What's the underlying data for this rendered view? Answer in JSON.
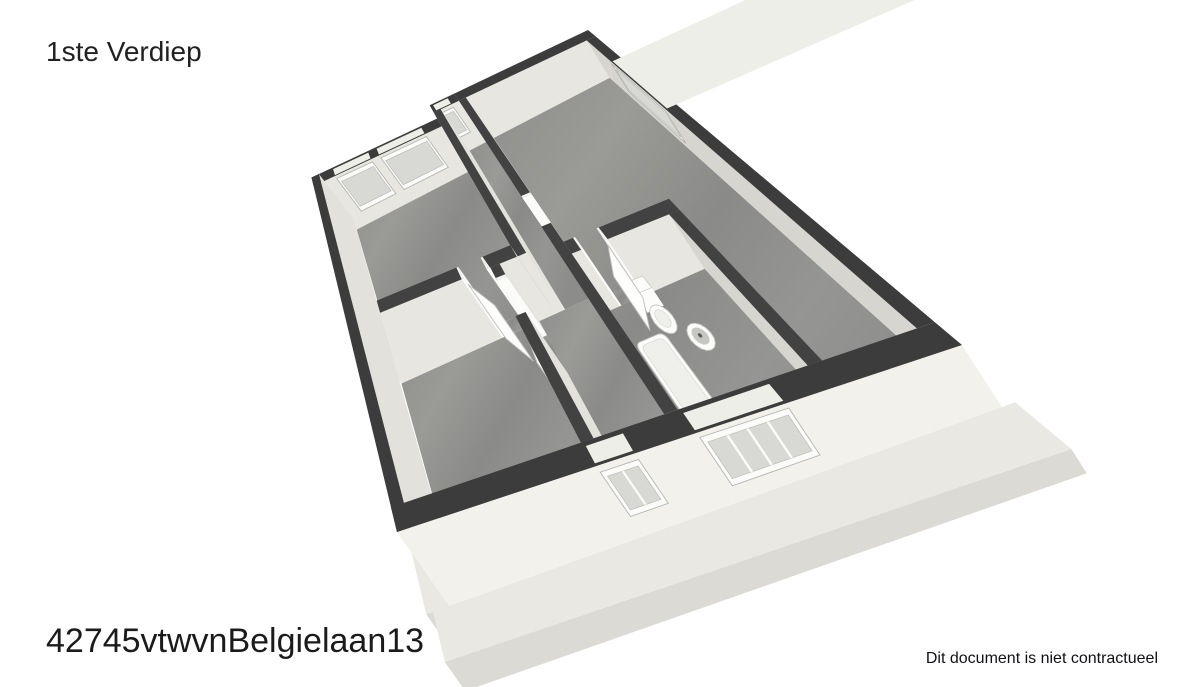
{
  "header": {
    "title": "1ste Verdiep"
  },
  "footer": {
    "reference": "42745vtwvnBelgielaan13",
    "disclaimer": "Dit document is niet contractueel"
  },
  "floorplan": {
    "plan_w": 10.0,
    "plan_h": 7.3,
    "calibration": {
      "quad": [
        [
          308,
          163
        ],
        [
          588,
          30
        ],
        [
          962,
          345
        ],
        [
          397,
          532
        ]
      ],
      "lifts": [
        [
          34,
          44
        ],
        [
          22,
          36
        ],
        [
          40,
          62
        ],
        [
          52,
          74
        ]
      ]
    },
    "colors": {
      "wall_top": "#3c3c3d",
      "wall_top_int": "#424243",
      "face_south_int": "#e7e6e0",
      "face_south_ext": "#f2f1ec",
      "face_north": "#ecebe5",
      "face_west": "#d6d5d0",
      "face_east": "#e2e1db",
      "white_piece": "#fbfbfa",
      "white_top": "#f4f4f2",
      "floor_stops": [
        "#8f8f8d",
        "#9a9a97",
        "#8a8a88",
        "#959593",
        "#8c8c8a"
      ],
      "ledge_top": "#e9e8e2",
      "ledge_face": "#dbdad4",
      "window_frame": "#fbfbfa",
      "window_pane": "#d8d8d5",
      "window_cap": "#eeeee8",
      "window_edge": "#b5b5b1",
      "door_leaf": "#fdfdfc",
      "door_edge": "#bdbdb9",
      "fix_white": "#fcfcfb",
      "fix_inner": "#efefec",
      "fix_bowl": "#c6c6c2",
      "fix_dark": "#5a5a58"
    },
    "ledges": [
      {
        "name": "slab-ledge-west",
        "x": -0.5,
        "y": 2.0,
        "w": 0.52,
        "d": 5.3
      },
      {
        "name": "slab-ledge-south",
        "x": -0.35,
        "y": 7.3,
        "w": 10.55,
        "d": 0.5
      }
    ],
    "floors": [
      {
        "name": "floor-bedroom-nw",
        "x": 0.28,
        "y": 0.78,
        "w": 4.3,
        "d": 3.27
      },
      {
        "name": "floor-corridor",
        "x": 4.82,
        "y": 0.28,
        "w": 0.64,
        "d": 4.01
      },
      {
        "name": "floor-hallway",
        "x": 4.14,
        "y": 4.29,
        "w": 1.32,
        "d": 2.73
      },
      {
        "name": "floor-bedroom-sw",
        "x": 0.28,
        "y": 4.29,
        "w": 3.62,
        "d": 2.73
      },
      {
        "name": "floor-living",
        "x": 5.7,
        "y": 0.28,
        "w": 4.02,
        "d": 6.74
      },
      {
        "name": "floor-threshold",
        "x": 3.2,
        "y": 4.05,
        "w": 0.6,
        "d": 0.24
      },
      {
        "name": "floor-threshold",
        "x": 3.9,
        "y": 4.5,
        "w": 0.24,
        "d": 0.7
      },
      {
        "name": "floor-threshold",
        "x": 5.46,
        "y": 3.23,
        "w": 0.24,
        "d": 0.72
      },
      {
        "name": "floor-threshold",
        "x": 5.93,
        "y": 4.36,
        "w": 0.57,
        "d": 0.24
      }
    ],
    "walls": [
      {
        "name": "wall-north-a",
        "x": 0,
        "y": 0.5,
        "w": 4.58,
        "d": 0.28,
        "ext": true,
        "win_side": "s",
        "windows": [
          {
            "a": 0.8,
            "b": 2.1,
            "t0": 0.26,
            "t1": 0.96
          },
          {
            "a": 2.4,
            "b": 4.0,
            "t0": 0.26,
            "t1": 0.96
          }
        ]
      },
      {
        "name": "wall-north-jog",
        "x": 4.58,
        "y": 0,
        "w": 0.88,
        "d": 0.28,
        "ext": true,
        "win_side": "s",
        "windows": [
          {
            "a": 4.68,
            "b": 5.2,
            "t0": 0.34,
            "t1": 0.94
          }
        ]
      },
      {
        "name": "wall-jog-filler",
        "x": 4.58,
        "y": 0.28,
        "w": 0.24,
        "d": 0.22,
        "ext": true
      },
      {
        "name": "wall-north-b",
        "x": 5.46,
        "y": 0,
        "w": 4.54,
        "d": 0.28,
        "ext": true
      },
      {
        "name": "wall-west",
        "x": 0,
        "y": 0.5,
        "w": 0.28,
        "d": 6.8,
        "ext": true
      },
      {
        "name": "wall-east",
        "x": 9.72,
        "y": 0.28,
        "w": 0.28,
        "d": 6.74,
        "ext": true,
        "win_side": "w",
        "windows": [
          {
            "a": 1.15,
            "b": 2.75,
            "t0": 0.26,
            "t1": 0.96
          }
        ]
      },
      {
        "name": "wall-south",
        "x": 0,
        "y": 7.02,
        "w": 10.0,
        "d": 0.28,
        "ext": true,
        "sface": "ext",
        "win_side": "s",
        "windows": [
          {
            "a": 3.95,
            "b": 4.65,
            "t0": 0.3,
            "t1": 0.94,
            "mullions": 1
          },
          {
            "a": 5.75,
            "b": 7.25,
            "t0": 0.24,
            "t1": 0.96,
            "mullions": 3
          }
        ]
      },
      {
        "name": "wall-a-east",
        "x": 4.58,
        "y": 0.28,
        "w": 0.24,
        "d": 4.01
      },
      {
        "name": "wall-a-south-w",
        "x": 0.28,
        "y": 4.05,
        "w": 2.92,
        "d": 0.24
      },
      {
        "name": "wall-a-south-e",
        "x": 3.8,
        "y": 4.05,
        "w": 0.78,
        "d": 0.24
      },
      {
        "name": "wall-c-east-n",
        "x": 3.9,
        "y": 4.29,
        "w": 0.24,
        "d": 0.26
      },
      {
        "name": "wall-c-east-s",
        "x": 3.9,
        "y": 5.2,
        "w": 0.24,
        "d": 1.82
      },
      {
        "name": "wall-b-west-n",
        "x": 5.46,
        "y": 0.28,
        "w": 0.24,
        "d": 3.0
      },
      {
        "name": "wall-b-west-s",
        "x": 5.46,
        "y": 3.95,
        "w": 0.24,
        "d": 3.07
      },
      {
        "name": "wall-bath-n-w",
        "x": 5.7,
        "y": 4.36,
        "w": 0.23,
        "d": 0.24
      },
      {
        "name": "wall-bath-n-e",
        "x": 6.55,
        "y": 4.36,
        "w": 1.65,
        "d": 0.24
      },
      {
        "name": "wall-bath-e",
        "x": 7.96,
        "y": 4.6,
        "w": 0.24,
        "d": 2.42
      },
      {
        "name": "door-jamb",
        "x": 3.15,
        "y": 4.05,
        "w": 0.05,
        "d": 0.24,
        "white": true
      },
      {
        "name": "door-jamb",
        "x": 3.8,
        "y": 4.05,
        "w": 0.05,
        "d": 0.24,
        "white": true
      },
      {
        "name": "door-jamb",
        "x": 3.9,
        "y": 4.5,
        "w": 0.24,
        "d": 0.05,
        "white": true
      },
      {
        "name": "door-jamb",
        "x": 3.9,
        "y": 5.2,
        "w": 0.24,
        "d": 0.05,
        "white": true
      },
      {
        "name": "door-jamb",
        "x": 5.46,
        "y": 3.23,
        "w": 0.24,
        "d": 0.05,
        "white": true
      },
      {
        "name": "door-jamb",
        "x": 5.46,
        "y": 3.95,
        "w": 0.24,
        "d": 0.05,
        "white": true
      },
      {
        "name": "door-jamb",
        "x": 5.93,
        "y": 4.36,
        "w": 0.05,
        "d": 0.24,
        "white": true
      },
      {
        "name": "door-jamb",
        "x": 6.5,
        "y": 4.36,
        "w": 0.05,
        "d": 0.24,
        "white": true
      }
    ],
    "door_leaves": [
      {
        "name": "door-leaf",
        "hx": 3.22,
        "hy": 4.33,
        "len": 0.62,
        "ang": 55
      },
      {
        "name": "door-leaf",
        "hx": 3.95,
        "hy": 5.24,
        "len": 0.64,
        "ang": 100
      },
      {
        "name": "door-leaf",
        "hx": 6.48,
        "hy": 4.62,
        "len": 0.58,
        "ang": 122
      },
      {
        "name": "door-leaf",
        "hx": 5.5,
        "hy": 3.21,
        "len": 0.6,
        "ang": -93
      }
    ],
    "fixtures": [
      {
        "type": "tank",
        "name": "toilet-tank",
        "x": 6.36,
        "y": 4.64,
        "w": 0.38,
        "d": 0.22,
        "h": 0.32
      },
      {
        "type": "ellipse",
        "name": "toilet-bowl",
        "cx": 6.55,
        "cy": 5.08,
        "rx": 0.2,
        "ry": 0.24,
        "irx": 0.12,
        "iry": 0.15
      },
      {
        "type": "sink",
        "name": "sink",
        "cx": 6.95,
        "cy": 5.5,
        "r": 0.21,
        "ir": 0.135,
        "dr": 0.035
      },
      {
        "type": "tub",
        "name": "bathtub",
        "x": 5.74,
        "y": 5.25,
        "w": 0.64,
        "d": 1.73,
        "inset": 0.07
      }
    ]
  }
}
